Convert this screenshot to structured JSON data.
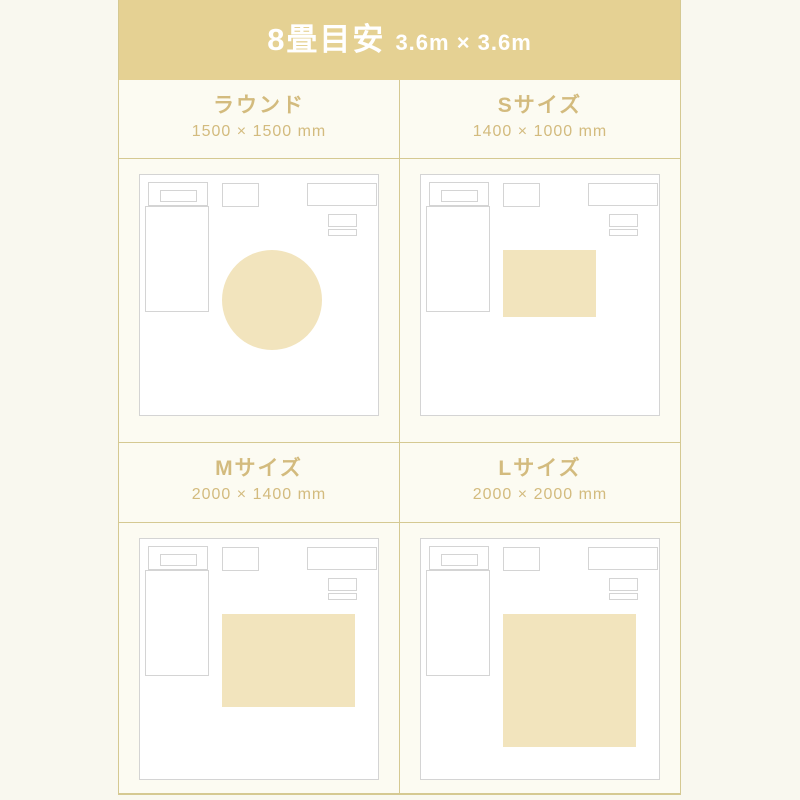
{
  "header": {
    "title": "8畳目安",
    "subtitle": "3.6m × 3.6m"
  },
  "room": {
    "width_mm": 3600,
    "depth_mm": 3600
  },
  "sections": [
    {
      "id": "round",
      "title": "ラウンド",
      "dims": "1500 × 1500 mm",
      "rug": {
        "shape": "circle",
        "w_mm": 1500,
        "h_mm": 1500
      }
    },
    {
      "id": "s",
      "title": "Sサイズ",
      "dims": "1400 × 1000 mm",
      "rug": {
        "shape": "rect",
        "w_mm": 1400,
        "h_mm": 1000
      }
    },
    {
      "id": "m",
      "title": "Mサイズ",
      "dims": "2000 × 1400 mm",
      "rug": {
        "shape": "rect",
        "w_mm": 2000,
        "h_mm": 1400
      }
    },
    {
      "id": "l",
      "title": "Lサイズ",
      "dims": "2000 × 2000 mm",
      "rug": {
        "shape": "rect",
        "w_mm": 2000,
        "h_mm": 2000
      }
    }
  ],
  "colors": {
    "page_bg": "#f9f8ef",
    "band_bg": "#e5d193",
    "band_text": "#ffffff",
    "label_text": "#d3bb7e",
    "divider": "#d5c992",
    "cell_bg": "#fcfbf2",
    "room_bg": "#ffffff",
    "outline": "#d4d4d4",
    "rug": "#f2e4bd"
  }
}
